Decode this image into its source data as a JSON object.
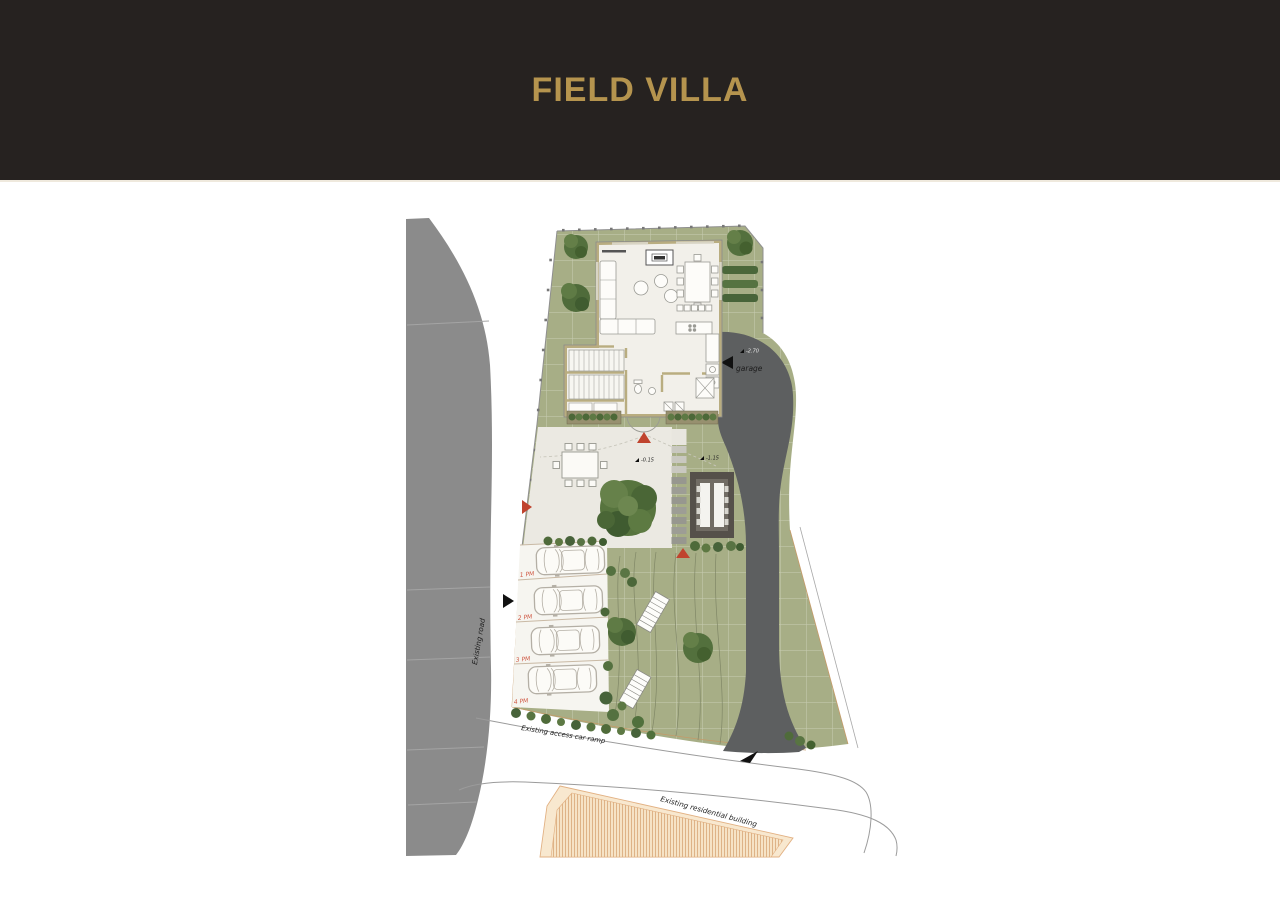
{
  "header": {
    "title": "FIELD VILLA",
    "background": "#262220",
    "title_color": "#b5944e"
  },
  "site_plan": {
    "labels": {
      "existing_road": "Existing road",
      "garage": "garage",
      "access_ramp": "Existing access car ramp",
      "residential_building": "Existing residential building"
    },
    "parking_labels": [
      "1 PM",
      "2 PM",
      "3 PM",
      "4 PM"
    ],
    "elevation_markers": [
      "-0.15",
      "-1.15",
      "-2.70"
    ],
    "colors": {
      "road": "#8b8b8b",
      "grass": "#a7ae86",
      "driveway": "#5d5f60",
      "terrace": "#ebe9e2",
      "building_wall": "#b9ad80",
      "building_floor": "#f2f0ea",
      "existing_building_fill": "#f8e8cf",
      "existing_building_hatch": "#dcae80",
      "marker_red": "#c0442e",
      "parking_label_red": "#cf5742",
      "tree_green": "#53703d"
    }
  }
}
